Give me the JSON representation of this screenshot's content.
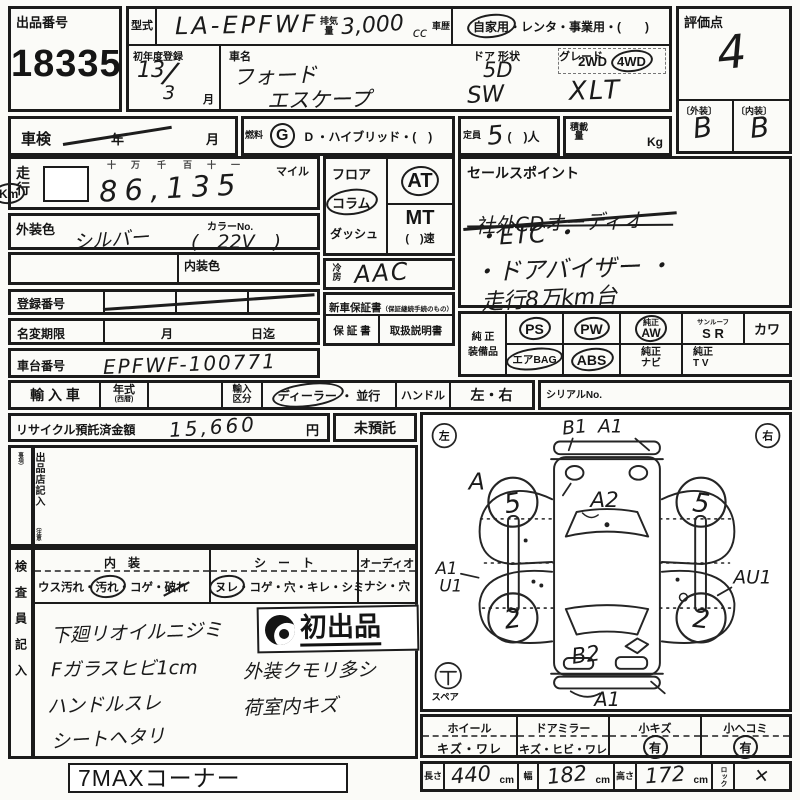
{
  "sheet": {
    "auction": {
      "label": "出品番号",
      "number": "18335"
    },
    "model": {
      "label": "型式",
      "value": "LA-EPFWF"
    },
    "displacement": {
      "label": "排気量",
      "value": "3,000",
      "unit": "cc"
    },
    "history": {
      "label": "車歴",
      "private": "自家用",
      "rest": "・レンタ・事業用・(　　)"
    },
    "first_reg": {
      "label": "初年度登録",
      "year": "13",
      "slash": "/",
      "month": "3",
      "month_label": "月"
    },
    "car_name": {
      "label": "車名",
      "make": "フォード",
      "model": "エスケープ"
    },
    "door": {
      "label": "ドア 形状",
      "doors": "5D",
      "shape": "SW"
    },
    "grade": {
      "label": "グレード",
      "value": "XLT"
    },
    "drive": {
      "two": "2WD",
      "four": "4WD"
    },
    "rating": {
      "label": "評価点",
      "value": "4",
      "ext_label": "〔外装〕",
      "ext": "B",
      "int_label": "〔内装〕",
      "int": "B"
    },
    "shaken": {
      "label": "車検",
      "year": "年",
      "month": "月"
    },
    "fuel": {
      "label": "燃料",
      "g": "G",
      "rest": "D ・ハイブリッド・(　)"
    },
    "capacity": {
      "label": "定員",
      "value": "5",
      "rest": "(　)人"
    },
    "load": {
      "label": "積載量",
      "unit": "Kg"
    },
    "mileage": {
      "label": "走行",
      "markers": [
        "十",
        "万",
        "千",
        "百",
        "十",
        "一"
      ],
      "value": "86,135",
      "mile": "マイル",
      "km": "Km"
    },
    "ext_color": {
      "label": "外装色",
      "value": "シルバー",
      "no_label": "カラーNo.",
      "no_value": "(　22V　)"
    },
    "int_color": {
      "label": "内装色"
    },
    "reg_no": {
      "label": "登録番号"
    },
    "name_change": {
      "label": "名変期限",
      "month": "月",
      "day": "日迄"
    },
    "chassis": {
      "label": "車台番号",
      "value": "EPFWF-100771"
    },
    "shift": {
      "floor": "フロア",
      "column": "コラム",
      "dash": "ダッシュ",
      "at": "AT",
      "mt": "MT",
      "speed": "(　)速"
    },
    "ac": {
      "label": "冷房",
      "value": "AAC"
    },
    "warranty": {
      "header": "新車保証書",
      "note": "（保証継続手続のもの）",
      "book": "保 証 書",
      "manual": "取扱説明書"
    },
    "sales": {
      "title": "セールスポイント",
      "crossed": "社外CDオーディオ",
      "etc": "・ETC ・",
      "visor": "・ドアバイザー ・",
      "mileage_note": "走行8万km台"
    },
    "equip": {
      "label1": "純 正",
      "label2": "装備品",
      "ps": "PS",
      "pw": "PW",
      "aw1": "純正",
      "aw2": "AW",
      "sr_small": "サンルーフ",
      "sr": "S R",
      "leather": "カワ",
      "airbag": "エアBAG",
      "abs": "ABS",
      "navi1": "純正",
      "navi2": "ナビ",
      "tv1": "純正",
      "tv2": "T V"
    },
    "import": {
      "label": "輸 入 車",
      "year": "年式",
      "year_note": "(西暦)",
      "class1": "輸入",
      "class2": "区分",
      "dealer": "ディーラー",
      "parallel": "・ 並行",
      "handle": "ハンドル",
      "lr": "左・右",
      "serial": "シリアルNo."
    },
    "recycle": {
      "label": "リサイクル預託済金額",
      "amount": "15,660",
      "yen": "円",
      "none": "未預託"
    },
    "seller": {
      "v1": "出品店記入",
      "v2": "（注意事項）"
    },
    "inspector": {
      "v": "検査員記入",
      "interior_h": "内　装",
      "int_pre": "ウス汚れ・",
      "int_circ": "汚れ",
      "int_mid": "・コゲ・",
      "int_strike": "破れ",
      "seat_h": "シ　ー　ト",
      "seat_circ": "ヌレ",
      "seat_rest": "・コゲ・穴・キレ・シミ",
      "audio_h": "オーディオ",
      "audio_v": "ナシ・穴",
      "n1": "下廻リオイルニジミ",
      "n2": "Fガラスヒビ1cm",
      "n3": "ハンドルスレ",
      "n4": "シートヘタリ",
      "n5": "外装クモリ多シ",
      "n6": "荷室内キズ",
      "stamp": "初出品"
    },
    "diagram": {
      "left": "左",
      "right": "右",
      "spare": "スペア",
      "b1": "B1",
      "a1t": "A1",
      "a": "A",
      "a2": "A2",
      "a1l": "A1",
      "u1": "U1",
      "au1": "AU1",
      "b2": "B2",
      "a1b": "A1",
      "wfl": "5",
      "wfr": "5",
      "wrl": "2",
      "wrr": "2"
    },
    "cond": {
      "wheel_h": "ホイール",
      "wheel_v": "キズ・ワレ",
      "mirror_h": "ドアミラー",
      "mirror_v": "キズ・ヒビ・ワレ",
      "scratch_h": "小キズ",
      "scratch_v": "有",
      "dent_h": "小ヘコミ",
      "dent_v": "有"
    },
    "dims": {
      "len_l": "長さ",
      "len_v": "440",
      "cm": "cm",
      "wid_l": "幅",
      "wid_v": "182",
      "hei_l": "高さ",
      "hei_v": "172",
      "lock_l": "ロック",
      "lock_v": "✕"
    },
    "footer": {
      "corner": "7MAXコーナー"
    }
  }
}
